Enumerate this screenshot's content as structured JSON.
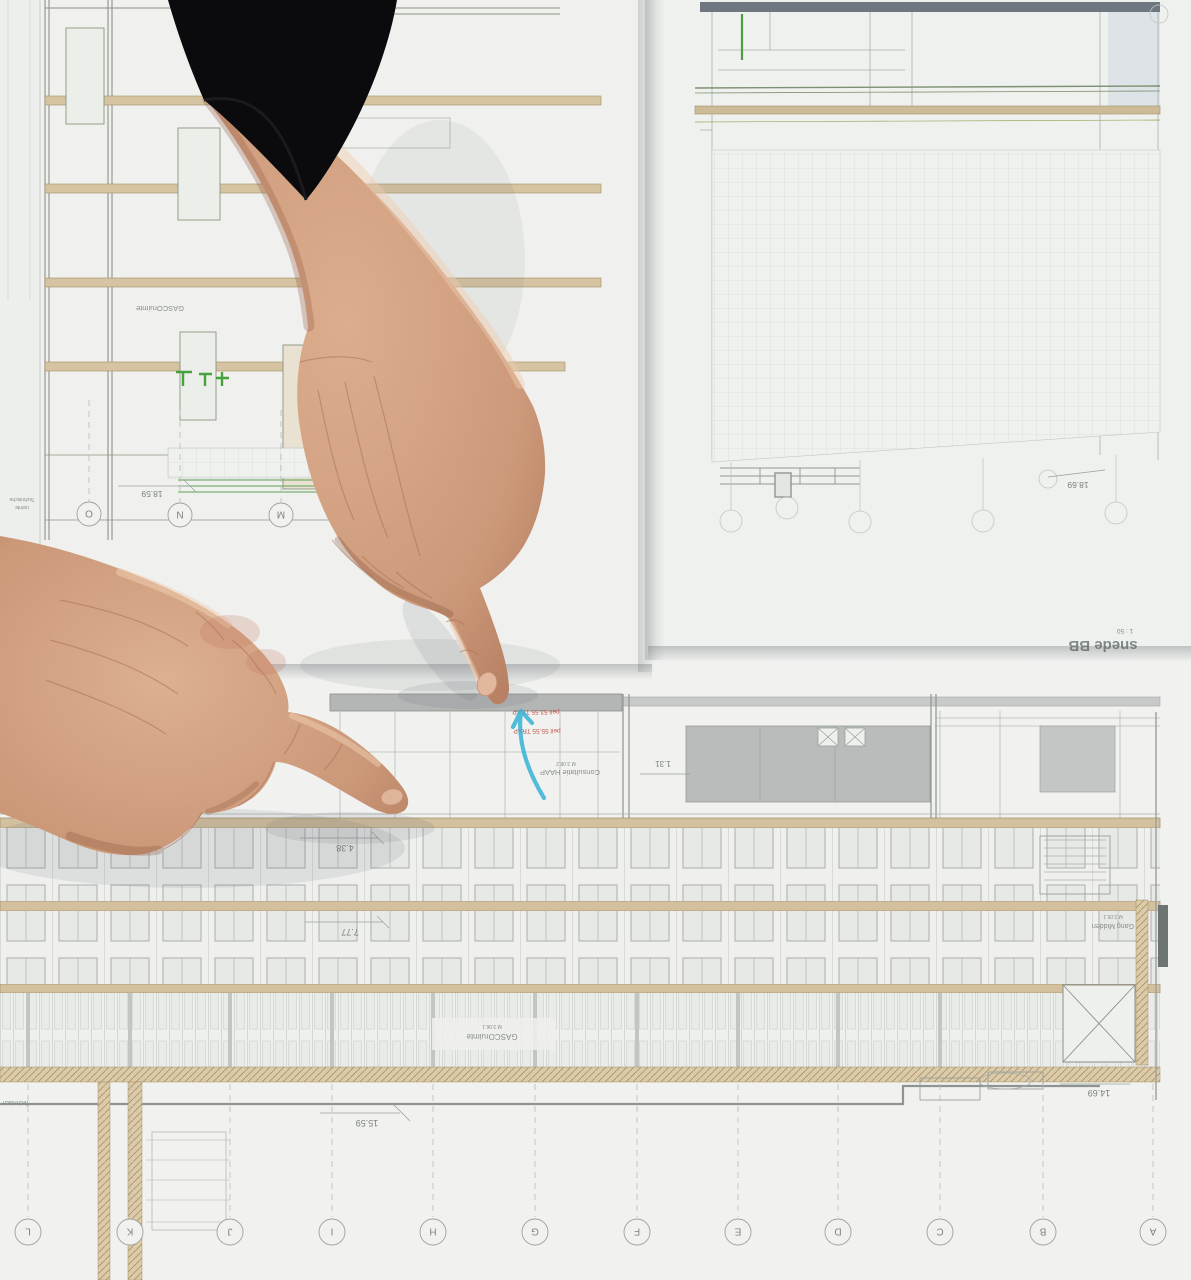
{
  "sheets": {
    "left_section": {
      "room_label": "GASCOruimte",
      "dimension_height": "18.59",
      "grid_bubbles": [
        "O",
        "N",
        "M"
      ],
      "margin_note_line1": "Technische",
      "margin_note_line2": "ruimte"
    },
    "plan_sheet": {
      "title": "snede BB",
      "scale_note": "1 : 50",
      "dimension_height": "18.69"
    },
    "main_section": {
      "red_note_line1": "peil 53.55 TRAP",
      "red_note_line2": "peil 55.55 TRAP",
      "room_consultatie": "Consultatie HAAP",
      "room_consultatie_code": "M 3.08.2",
      "dim_width": "1.31",
      "level_1": "4.38",
      "level_2": "7.77",
      "level_3": "11.16",
      "room_gasco": "GASCOruimte",
      "room_gasco_code": "M 3.06.1",
      "room_gang": "Gang Midden",
      "room_gang_code": "M 2.05.1",
      "level_4": "15.59",
      "level_5": "14.69",
      "corner_note": "Technisch",
      "grid_bubbles": [
        "L",
        "K",
        "J",
        "I",
        "H",
        "G",
        "F",
        "E",
        "D",
        "C",
        "B",
        "A"
      ]
    }
  },
  "annotations": {
    "marker_color": "#3ab5d8",
    "note_color": "#c4524b"
  },
  "colors": {
    "paper": "#f1f2ef",
    "floor_band_tan": "#d3c09e",
    "line_gray": "#9aa09d",
    "line_green": "#7d9070",
    "sleeve_black": "#0b0b0e",
    "skin": "#d2a384"
  }
}
